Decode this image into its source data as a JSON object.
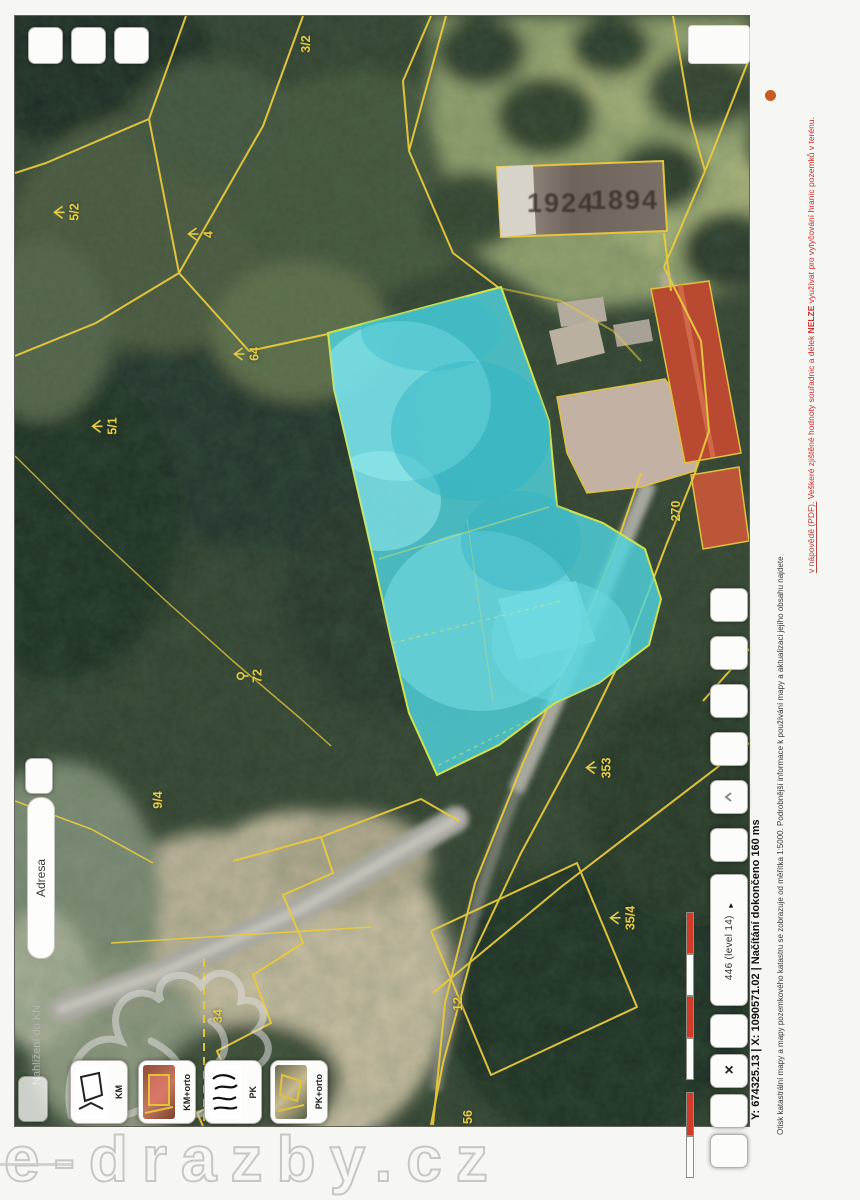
{
  "header": {
    "app_title": "Nahlížení do KN",
    "search_label": "Adresa"
  },
  "right_toolbar": {
    "level_text": "446 (level 14)",
    "level_arrow": "▾",
    "close_label": "×"
  },
  "statusbar": {
    "text": "Y: 674325.13   |   X: 1090571.02   |   Načítání dokončeno 160 ms"
  },
  "disclaimer": {
    "part1": "Otisk katastrální mapy a mapy pozemkového katastru se zobrazuje od měřítka 1:5000. Podrobnější informace k používání mapy a aktualizaci jejího obsahu najdete",
    "link": "v nápovědě (PDF).",
    "warn_pre": " Veškeré zjištěné hodnoty souřadnic a délek ",
    "warn_bold": "NELZE",
    "warn_post": " využívat pro vytyčování hranic pozemků v terénu."
  },
  "layers": {
    "items": [
      {
        "label": "KM"
      },
      {
        "label": "KM+orto"
      },
      {
        "label": "PK"
      },
      {
        "label": "PK+orto"
      }
    ]
  },
  "map": {
    "year_left": "1924",
    "year_right": "1894",
    "labels": [
      {
        "text": "3/2",
        "x": 306,
        "y": 44,
        "sym": ""
      },
      {
        "text": "5/2",
        "x": 66,
        "y": 212,
        "sym": "forest"
      },
      {
        "text": "4",
        "x": 200,
        "y": 234,
        "sym": "forest"
      },
      {
        "text": "64",
        "x": 246,
        "y": 354,
        "sym": "forest"
      },
      {
        "text": "5/1",
        "x": 104,
        "y": 426,
        "sym": "forest"
      },
      {
        "text": "72",
        "x": 250,
        "y": 676,
        "sym": "meadow"
      },
      {
        "text": "270",
        "x": 676,
        "y": 511,
        "sym": ""
      },
      {
        "text": "353",
        "x": 598,
        "y": 768,
        "sym": "forest"
      },
      {
        "text": "35/4",
        "x": 622,
        "y": 918,
        "sym": "forest"
      },
      {
        "text": "9/4",
        "x": 158,
        "y": 800,
        "sym": ""
      },
      {
        "text": "34",
        "x": 218,
        "y": 1016,
        "sym": ""
      },
      {
        "text": "12",
        "x": 458,
        "y": 1004,
        "sym": ""
      },
      {
        "text": "56",
        "x": 468,
        "y": 1117,
        "sym": ""
      }
    ]
  },
  "watermark": "e-drazby.cz",
  "colors": {
    "highlight_parcel": "#4fd3de",
    "cadastral_line": "#e8ca3e",
    "warning_text": "#cc2a2a"
  }
}
